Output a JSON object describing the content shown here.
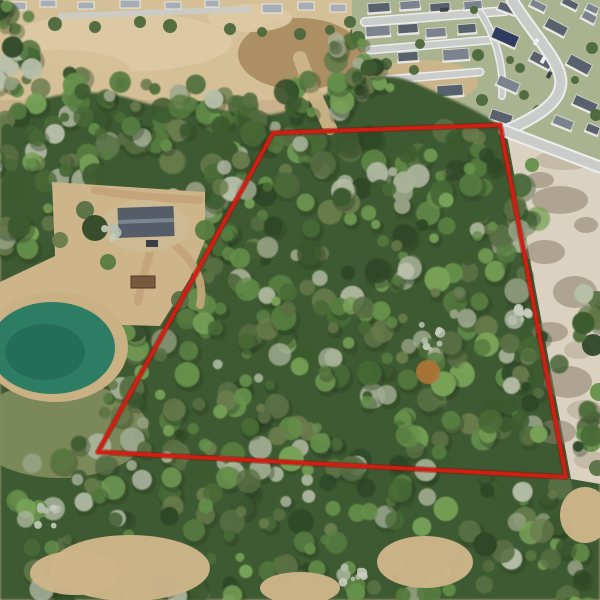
{
  "image": {
    "alt": "Aerial drone photo of a wooded land parcel outlined with a red boundary line, beside a pond, a homestead with dirt driveways, an open tan field, a suburban neighborhood with gray and navy rooftops, and a cleared sandy lot"
  },
  "palette": {
    "base_tan": "#c9b28b",
    "field_light": "#d4bf96",
    "field_pale": "#dccaa4",
    "field_brown": "#a88b5e",
    "lawn": "#aab390",
    "road": "#caccc9",
    "road_edge": "#eceded",
    "forest_base": "#3e5a32",
    "canopy_shadow": "#26391f",
    "sand": "#dad1c1",
    "sand_mottle": "#8a7f69",
    "sand_mottle_light": "#b3a78e",
    "dirt": "#c2a478",
    "dirt_light": "#cdb589",
    "grass_scrub": "#7e8b5c",
    "wall_white": "#e9e8e4",
    "pond_water": "#2d7c64",
    "pond_deep": "#1e6350",
    "pond_shore": "#c9b183",
    "bare_tree": "#c6cdbd",
    "rust_tree": "#b07337",
    "tree_dot": "#4c683c",
    "roof_dark": "#59616c",
    "roof_mid": "#7b838e",
    "roof_navy": "#303b60",
    "roof_light": "#a7adb5",
    "car_dark": "#3a4148",
    "car_white": "#f0f0ee"
  },
  "boundary": {
    "points": "273,133 500,125 566,477 98,452",
    "color": "#d21e12",
    "shadow_color": "#8c150a",
    "width": 3.6
  },
  "scene": {
    "field": {
      "rect": [
        0,
        0,
        362,
        100
      ],
      "patches": [
        [
          120,
          42,
          112,
          30,
          "field_pale"
        ],
        [
          300,
          54,
          62,
          36,
          "field_brown"
        ],
        [
          250,
          18,
          42,
          14,
          "field_pale"
        ],
        [
          60,
          70,
          70,
          20,
          "field_light"
        ]
      ],
      "road": "M58,16 L250,9",
      "houses": [
        [
          8,
          2,
          18,
          8
        ],
        [
          40,
          0,
          16,
          7
        ],
        [
          78,
          2,
          16,
          7
        ],
        [
          120,
          0,
          20,
          8
        ],
        [
          165,
          2,
          16,
          7
        ],
        [
          205,
          0,
          14,
          7
        ],
        [
          262,
          4,
          20,
          9
        ],
        [
          298,
          2,
          16,
          8
        ],
        [
          330,
          4,
          16,
          8
        ]
      ],
      "tree_dots": [
        [
          55,
          24,
          7
        ],
        [
          95,
          27,
          6
        ],
        [
          140,
          22,
          6
        ],
        [
          170,
          26,
          7
        ],
        [
          230,
          29,
          6
        ],
        [
          262,
          32,
          5
        ],
        [
          300,
          34,
          6
        ],
        [
          330,
          30,
          5
        ],
        [
          356,
          33,
          6
        ]
      ]
    },
    "neighborhood": {
      "lawn_points": "352,0 600,0 600,172 505,131 430,92 378,70 352,40",
      "dirt_patch": [
        423,
        82,
        55,
        22
      ],
      "streets": [
        {
          "d": "M365,22 L505,11",
          "w": 7
        },
        {
          "d": "M370,50 L490,40",
          "w": 6
        },
        {
          "d": "M384,80 L480,72",
          "w": 6
        },
        {
          "d": "M480,12 C498,40 504,70 502,96",
          "w": 5
        }
      ],
      "houses": [
        [
          368,
          3,
          22,
          10,
          "dark",
          -4
        ],
        [
          400,
          1,
          20,
          9,
          "mid",
          -4
        ],
        [
          430,
          3,
          20,
          9,
          "dark",
          -4
        ],
        [
          464,
          1,
          18,
          9,
          "mid",
          -4
        ],
        [
          498,
          4,
          18,
          9,
          "dark",
          20
        ],
        [
          530,
          2,
          16,
          8,
          "mid",
          26
        ],
        [
          562,
          0,
          16,
          8,
          "dark",
          26
        ],
        [
          586,
          5,
          12,
          8,
          "mid",
          26
        ],
        [
          366,
          26,
          24,
          11,
          "mid",
          -4
        ],
        [
          398,
          24,
          20,
          10,
          "dark",
          -4
        ],
        [
          426,
          28,
          20,
          10,
          "mid",
          -4
        ],
        [
          458,
          24,
          18,
          10,
          "dark",
          -4
        ],
        [
          545,
          22,
          22,
          11,
          "dark",
          28
        ],
        [
          582,
          13,
          14,
          9,
          "mid",
          28
        ],
        [
          398,
          52,
          20,
          10,
          "dark",
          -4
        ],
        [
          443,
          49,
          26,
          12,
          "mid",
          -4
        ],
        [
          492,
          31,
          26,
          13,
          "navy",
          24
        ],
        [
          530,
          55,
          22,
          11,
          "dark",
          28
        ],
        [
          567,
          59,
          24,
          12,
          "dark",
          28
        ],
        [
          437,
          85,
          26,
          12,
          "dark",
          -4
        ],
        [
          400,
          95,
          24,
          11,
          "mid",
          -4
        ],
        [
          497,
          79,
          22,
          11,
          "mid",
          24
        ],
        [
          573,
          99,
          24,
          11,
          "dark",
          24
        ],
        [
          490,
          112,
          22,
          11,
          "dark",
          18
        ],
        [
          457,
          131,
          22,
          11,
          "mid",
          -4
        ],
        [
          553,
          118,
          20,
          10,
          "mid",
          22
        ],
        [
          586,
          125,
          13,
          9,
          "dark",
          22
        ]
      ],
      "tree_dots": [
        [
          358,
          38,
          7
        ],
        [
          386,
          64,
          6
        ],
        [
          420,
          44,
          5
        ],
        [
          478,
          55,
          6
        ],
        [
          520,
          68,
          5
        ],
        [
          545,
          44,
          5
        ],
        [
          592,
          48,
          6
        ],
        [
          482,
          100,
          6
        ],
        [
          524,
          95,
          5
        ],
        [
          560,
          85,
          5
        ],
        [
          596,
          115,
          6
        ],
        [
          428,
          114,
          6
        ],
        [
          414,
          70,
          5
        ],
        [
          350,
          22,
          6
        ],
        [
          474,
          10,
          4
        ],
        [
          510,
          60,
          4
        ],
        [
          538,
          110,
          5
        ],
        [
          575,
          80,
          4
        ]
      ],
      "cars": [
        [
          536,
          38,
          4,
          7,
          "car_white",
          28
        ],
        [
          543,
          56,
          4,
          7,
          "car_white",
          28
        ],
        [
          549,
          71,
          4,
          7,
          "car_dark",
          28
        ],
        [
          440,
          8,
          8,
          4,
          "car_dark",
          -4
        ]
      ]
    },
    "forest": {
      "base_path": "M0,118 C40,92 95,86 135,100 C175,114 215,106 252,114 C282,120 312,98 338,90 C360,83 382,66 422,86 C462,104 486,114 507,131 L600,200 L600,600 L0,600 Z",
      "greens": [
        "#2e4827",
        "#3c5a2f",
        "#496b37",
        "#577c40",
        "#66904b",
        "#78a257",
        "#697c4c",
        "#597044"
      ],
      "sage": [
        "#96a183",
        "#a8b298",
        "#b7bfa9"
      ],
      "clusters": [
        [
          70,
          95,
          65,
          22,
          16
        ],
        [
          170,
          105,
          70,
          24,
          18
        ],
        [
          260,
          110,
          55,
          22,
          14
        ],
        [
          330,
          95,
          45,
          20,
          12
        ],
        [
          210,
          140,
          80,
          25,
          16
        ],
        [
          90,
          130,
          60,
          22,
          14
        ],
        [
          30,
          170,
          40,
          35,
          14
        ],
        [
          70,
          200,
          35,
          30,
          12
        ],
        [
          25,
          250,
          35,
          35,
          12
        ],
        [
          95,
          165,
          35,
          25,
          10
        ],
        [
          100,
          252,
          26,
          16,
          8
        ],
        [
          192,
          215,
          35,
          25,
          10
        ],
        [
          222,
          252,
          30,
          25,
          9
        ],
        [
          260,
          170,
          60,
          32,
          16
        ],
        [
          350,
          155,
          60,
          30,
          16
        ],
        [
          440,
          155,
          55,
          30,
          14
        ],
        [
          300,
          200,
          65,
          35,
          16
        ],
        [
          400,
          195,
          60,
          35,
          15
        ],
        [
          478,
          192,
          45,
          30,
          12
        ],
        [
          190,
          290,
          55,
          40,
          14
        ],
        [
          270,
          265,
          60,
          38,
          15
        ],
        [
          360,
          255,
          65,
          38,
          16
        ],
        [
          450,
          250,
          55,
          38,
          14
        ],
        [
          512,
          238,
          38,
          32,
          11
        ],
        [
          150,
          360,
          50,
          38,
          13
        ],
        [
          240,
          330,
          60,
          40,
          15
        ],
        [
          330,
          320,
          65,
          40,
          16
        ],
        [
          420,
          315,
          60,
          40,
          15
        ],
        [
          498,
          302,
          42,
          38,
          12
        ],
        [
          130,
          420,
          50,
          35,
          12
        ],
        [
          220,
          400,
          60,
          40,
          15
        ],
        [
          310,
          390,
          65,
          42,
          16
        ],
        [
          400,
          385,
          60,
          40,
          15
        ],
        [
          478,
          375,
          52,
          40,
          14
        ],
        [
          532,
          362,
          32,
          35,
          10
        ],
        [
          180,
          455,
          60,
          32,
          14
        ],
        [
          280,
          450,
          65,
          35,
          15
        ],
        [
          370,
          440,
          60,
          38,
          15
        ],
        [
          460,
          435,
          55,
          35,
          13
        ],
        [
          523,
          430,
          38,
          30,
          10
        ],
        [
          60,
          480,
          55,
          40,
          13
        ],
        [
          30,
          545,
          45,
          40,
          12
        ],
        [
          150,
          510,
          60,
          35,
          13
        ],
        [
          250,
          505,
          60,
          35,
          14
        ],
        [
          350,
          505,
          60,
          38,
          14
        ],
        [
          450,
          500,
          55,
          35,
          13
        ],
        [
          528,
          495,
          45,
          30,
          11
        ],
        [
          90,
          592,
          50,
          22,
          10
        ],
        [
          210,
          578,
          50,
          26,
          11
        ],
        [
          310,
          562,
          45,
          26,
          10
        ],
        [
          390,
          582,
          50,
          28,
          11
        ],
        [
          480,
          572,
          45,
          28,
          10
        ],
        [
          558,
          548,
          42,
          32,
          11
        ],
        [
          585,
          592,
          28,
          18,
          8
        ],
        [
          593,
          322,
          16,
          38,
          8
        ],
        [
          590,
          432,
          14,
          28,
          6
        ],
        [
          352,
          45,
          24,
          22,
          8
        ],
        [
          372,
          76,
          24,
          18,
          7
        ],
        [
          12,
          18,
          18,
          14,
          6
        ],
        [
          18,
          60,
          22,
          18,
          7
        ],
        [
          0,
          105,
          25,
          25,
          8
        ]
      ]
    },
    "sand_lot": {
      "points": "507,136 600,171 600,484 571,479",
      "mottles": [
        [
          560,
          200,
          28,
          14,
          "d"
        ],
        [
          545,
          252,
          20,
          12,
          "d"
        ],
        [
          575,
          292,
          22,
          16,
          "d"
        ],
        [
          550,
          332,
          18,
          10,
          "d"
        ],
        [
          568,
          382,
          24,
          16,
          "d"
        ],
        [
          556,
          432,
          20,
          12,
          "d"
        ],
        [
          586,
          225,
          12,
          8,
          "d"
        ],
        [
          540,
          180,
          14,
          8,
          "d"
        ],
        [
          578,
          350,
          14,
          9,
          "l"
        ],
        [
          590,
          460,
          16,
          9,
          "l"
        ],
        [
          565,
          160,
          30,
          10,
          "l"
        ],
        [
          585,
          410,
          18,
          10,
          "l"
        ]
      ],
      "shrubs": [
        [
          597,
          300,
          9
        ],
        [
          593,
          345,
          11
        ],
        [
          599,
          392,
          9
        ],
        [
          591,
          442,
          10
        ],
        [
          597,
          468,
          8
        ],
        [
          532,
          165,
          7
        ]
      ]
    },
    "roads_main": [
      {
        "d": "M512,0 C530,30 555,55 560,75 C565,95 550,112 505,131",
        "w": 9
      },
      {
        "d": "M505,131 L600,167",
        "w": 9
      }
    ],
    "grass_patch": [
      60,
      430,
      88,
      48
    ],
    "trail": {
      "d": "M300,58 C308,82 318,102 330,128",
      "w": 14
    },
    "homestead": {
      "clearing_points": "52,182 205,192 205,240 190,278 160,326 0,322 0,282 55,256",
      "pad": [
        145,
        226,
        44,
        26
      ],
      "house": [
        118,
        207,
        56,
        30
      ],
      "ridge": [
        118,
        219,
        56,
        4
      ],
      "shed": [
        131,
        276,
        24,
        12
      ],
      "cars": [
        [
          146,
          240,
          12,
          7
        ]
      ],
      "driveways": [
        "M175,245 C195,262 205,282 200,305",
        "M150,252 C145,270 141,286 138,302",
        "M95,190 C130,196 165,198 200,200"
      ],
      "trees": [
        [
          85,
          210,
          9
        ],
        [
          205,
          230,
          10
        ],
        [
          108,
          262,
          8
        ],
        [
          180,
          300,
          9
        ],
        [
          95,
          228,
          13
        ],
        [
          60,
          240,
          8
        ]
      ]
    },
    "pond": {
      "shore": [
        55,
        347,
        73,
        55
      ],
      "water": [
        52,
        348,
        63,
        46
      ],
      "deep": [
        45,
        352,
        40,
        28
      ]
    },
    "clearings": [
      [
        130,
        568,
        80,
        33
      ],
      [
        300,
        588,
        40,
        16
      ],
      [
        425,
        562,
        48,
        26
      ],
      [
        585,
        515,
        25,
        28
      ],
      [
        75,
        573,
        45,
        22
      ]
    ],
    "bare_trees": [
      [
        42,
        516,
        20
      ],
      [
        352,
        574,
        14
      ],
      [
        110,
        232,
        9
      ],
      [
        430,
        335,
        18
      ],
      [
        520,
        315,
        10
      ]
    ],
    "rust_trees": [
      [
        428,
        372,
        12
      ]
    ]
  }
}
